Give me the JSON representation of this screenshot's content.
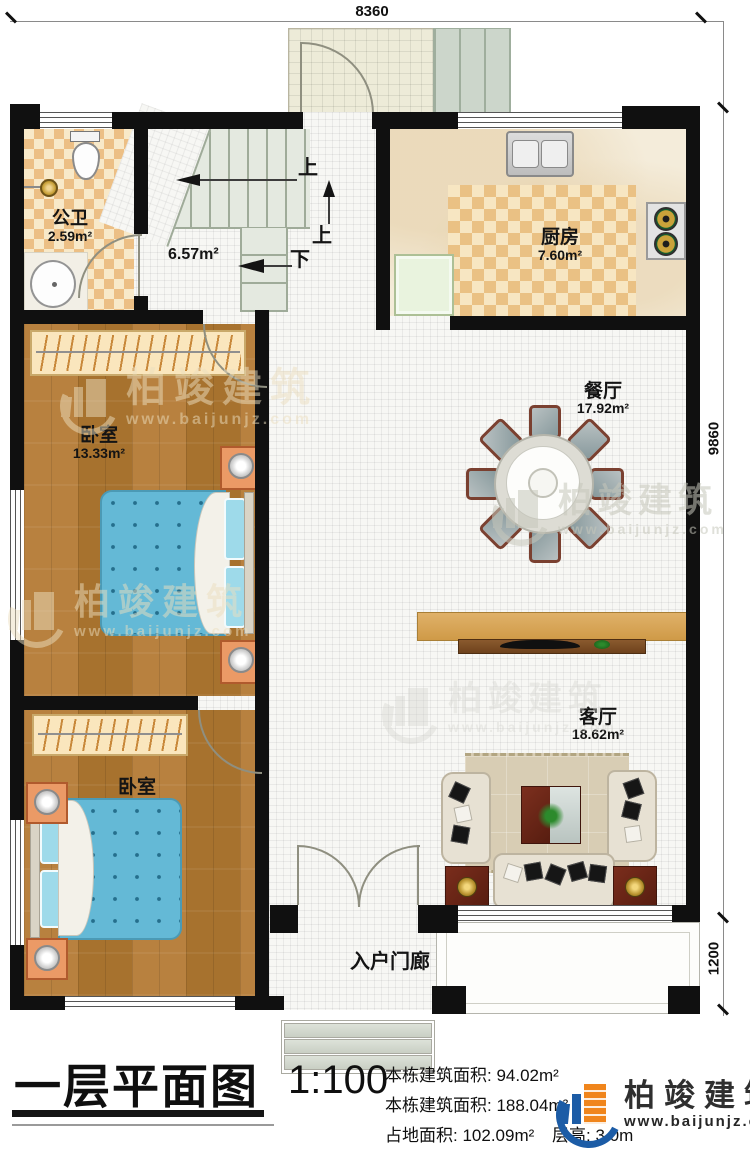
{
  "brand": {
    "name": "柏竣建筑",
    "site": "www.baijunjz.com"
  },
  "dimensions": {
    "width_top": "8360",
    "height_main": "9860",
    "height_porch": "1200"
  },
  "rooms": {
    "bathroom": {
      "name": "公卫",
      "area": "2.59m²"
    },
    "stairwell": {
      "area": "6.57m²"
    },
    "kitchen": {
      "name": "厨房",
      "area": "7.60m²"
    },
    "dining": {
      "name": "餐厅",
      "area": "17.92m²"
    },
    "living": {
      "name": "客厅",
      "area": "18.62m²"
    },
    "bedroom_upper": {
      "name": "卧室",
      "area": "13.33m²"
    },
    "bedroom_lower": {
      "name": "卧室",
      "area": "10.07m²"
    },
    "porch": {
      "name": "入户门廊"
    }
  },
  "stairs": {
    "up_label_1": "上",
    "up_label_2": "上",
    "down_label": "下"
  },
  "title_block": {
    "title": "一层平面图",
    "scale": "1:100",
    "stats": [
      {
        "label": "本栋建筑面积:",
        "value": "94.02m²"
      },
      {
        "label": "本栋建筑面积:",
        "value": "188.04m²"
      },
      {
        "label": "占地面积:",
        "value": "102.09m²"
      },
      {
        "label": "层高:",
        "value": "3.0m"
      }
    ]
  }
}
